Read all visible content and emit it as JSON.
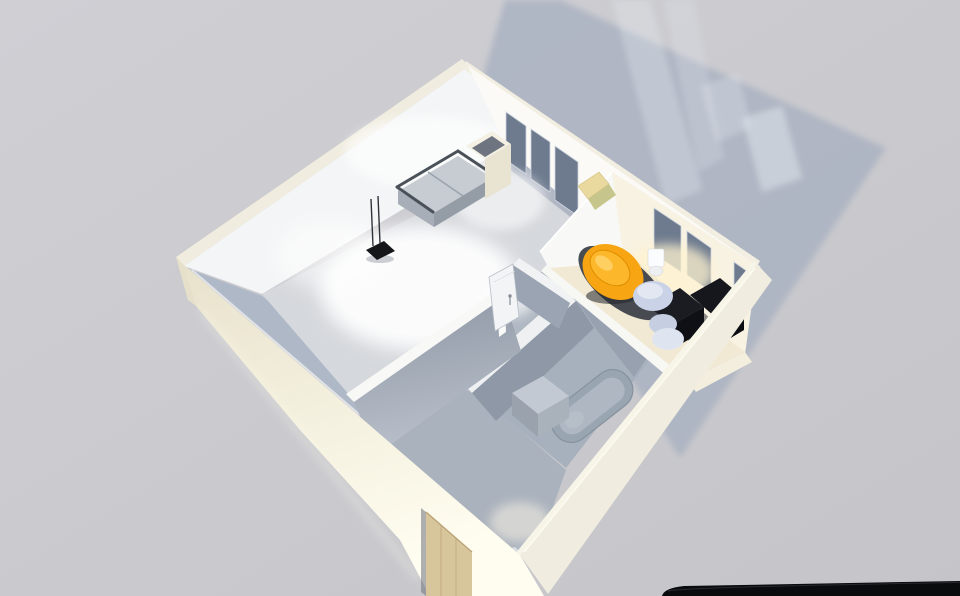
{
  "app": {
    "type": "3d-floorplan-render",
    "description": "Isometric 3D render of a one-bedroom apartment viewed from above, casting a window-light shadow on a gray floor"
  },
  "colors": {
    "background_top": "#cfcfd4",
    "background_bottom": "#c5c5c9",
    "shadow": "#a9b2c1",
    "shadow_streak": "#e2e7ee",
    "wall_cream_outer": "#f0ecdf",
    "wall_cream_band": "#f2eee1",
    "wall_cream_dark": "#e8e2cc",
    "wall_cream_bright": "#fffdf0",
    "wall_white_inner": "#f4f5f6",
    "wall_white_inner2": "#fbfaf7",
    "wall_inner_sw": "#aeb8c6",
    "wall_warm_overlay": "#f5e9cd",
    "partition_top": "#f8f8f6",
    "partition_gray": "#8d96a4",
    "partition_gray2": "#9aa4b2",
    "bath_wall_gray": "#8e98a7",
    "bath_wall_gray2": "#97a1af",
    "window_glass": "#6e7b8f",
    "window_frame": "#ccd3dc",
    "floor_living": "#d5d8dc",
    "floor_hall": "#b0b8c3",
    "floor_entry": "#aab2bd",
    "floor_bathroom": "#a7b0bd",
    "floor_bedroom": "#f2e9d5",
    "floor_bedroom_ledge": "#f3eede",
    "rug": "#3d424a",
    "sofa_seat": "#c7ccd3",
    "sofa_front": "#949ca6",
    "sofa_frame": "#4a5159",
    "sofa_table": "#f4f0e3",
    "sofa_table_top": "#6e7580",
    "tv_black": "#14161a",
    "lounge_chair_yellow": "#ead99f",
    "lounge_chair_green": "#c6c68c",
    "chair_orange": "#f7a513",
    "chair_orange_rim": "#fdb72b",
    "chair_orange_hi": "#ffd36b",
    "pouf_blue": "#c9d2e6",
    "pouf_blue_top": "#e2e7f2",
    "desk_black": "#15171c",
    "desk_black_face": "#0b0d11",
    "desk_chair_seat": "#dfe5f0",
    "desk_chair_back": "#c6cfe2",
    "tub_outer": "#9aa5b2",
    "tub_inner": "#aeb7c2",
    "washer_top": "#c2c9d2",
    "washer_left": "#99a2ad",
    "washer_right": "#a9b1bb",
    "door_wood": "#d7c59c",
    "door_wood_line": "#c3ad7e",
    "door_panel": "#f2f4f6",
    "wall_object_white": "#fbfcfd",
    "foreground_object": "#0a0b0d"
  },
  "scene": {
    "rooms": [
      {
        "name": "living-room",
        "floor": "light gray with bright light pool"
      },
      {
        "name": "bedroom",
        "floor": "warm cream with dark rug"
      },
      {
        "name": "bathroom",
        "floor": "shadowed blue-gray"
      },
      {
        "name": "entry-hall",
        "floor": "shadowed gray"
      }
    ],
    "furniture": [
      {
        "name": "sofa",
        "room": "living-room"
      },
      {
        "name": "side-table",
        "room": "living-room"
      },
      {
        "name": "tv-device-with-antennas",
        "room": "living-room"
      },
      {
        "name": "yellow-lounge-chair",
        "room": "living-room"
      },
      {
        "name": "orange-round-chair",
        "room": "bedroom"
      },
      {
        "name": "blue-pouf",
        "room": "bedroom"
      },
      {
        "name": "black-desk",
        "room": "bedroom"
      },
      {
        "name": "desk-chair",
        "room": "bedroom"
      },
      {
        "name": "wall-basin",
        "room": "bedroom"
      },
      {
        "name": "bathtub",
        "room": "bathroom"
      },
      {
        "name": "washing-machine",
        "room": "bathroom"
      }
    ],
    "windows_count": 6,
    "doors": [
      {
        "name": "entry-door",
        "material": "wood"
      },
      {
        "name": "interior-door",
        "state": "open"
      }
    ]
  }
}
